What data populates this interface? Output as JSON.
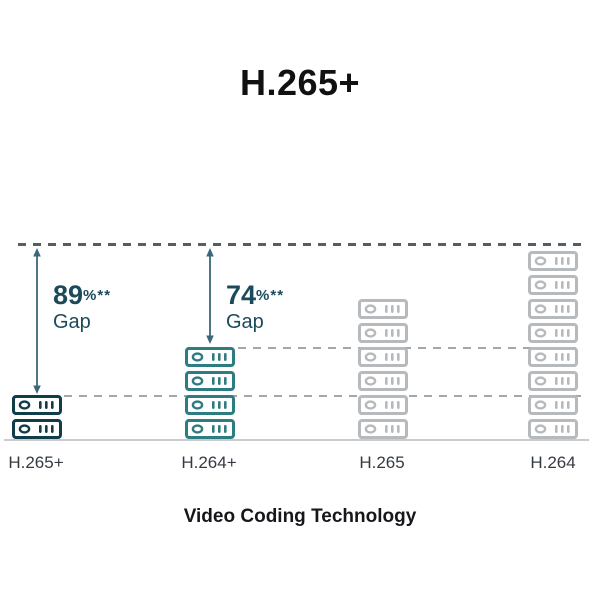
{
  "header": {
    "title": "H.265+"
  },
  "chart_data": {
    "type": "bar",
    "subtype": "pictograph",
    "title": "H.265+",
    "xlabel": "Video Coding Technology",
    "ylabel": "",
    "unit_icon": "storage-drive-icon",
    "legend_position": "none",
    "grid": "horizontal dashed reference lines at 8, 4 and 2 drive levels",
    "categories": [
      {
        "label": "H.265+",
        "drive_count": 2,
        "color": "#113c4a"
      },
      {
        "label": "H.264+",
        "drive_count": 4,
        "color": "#2c7c81"
      },
      {
        "label": "H.265",
        "drive_count": 6,
        "color": "#b7babc"
      },
      {
        "label": "H.264",
        "drive_count": 8,
        "color": "#b7babc"
      }
    ],
    "annotations": [
      {
        "value": "89",
        "suffix": "%**",
        "caption": "Gap",
        "gap_between": [
          "H.264",
          "H.265+"
        ]
      },
      {
        "value": "74",
        "suffix": "%**",
        "caption": "Gap",
        "gap_between": [
          "H.264",
          "H.264+"
        ]
      }
    ],
    "reference_levels_in_drives": [
      8,
      4,
      2
    ],
    "colors": {
      "title": "#111111",
      "top_reference_line": "#545e66",
      "reference_line": "#a2a7ab",
      "baseline": "#c9cbcd",
      "arrow": "#3a6878",
      "annotation_text": "#1b4a5a",
      "category_label": "#343a41",
      "axis_title": "#15171a",
      "drive_fill": "#ffffff"
    }
  }
}
